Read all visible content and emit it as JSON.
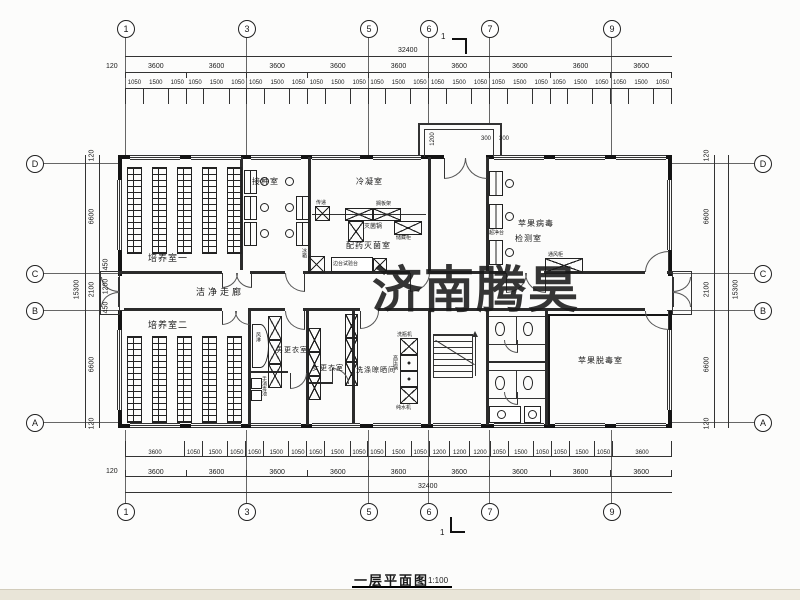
{
  "watermark": {
    "text": "济南腾昊",
    "color": "#e0394b"
  },
  "title": {
    "name": "一层平面图",
    "scale": "1:100"
  },
  "grid": {
    "top": [
      "1",
      "3",
      "5",
      "6",
      "7",
      "9"
    ],
    "bottom": [
      "1",
      "3",
      "5",
      "6",
      "7",
      "9"
    ],
    "left": [
      "D",
      "C",
      "B",
      "A"
    ],
    "right": [
      "D",
      "C",
      "B",
      "A"
    ]
  },
  "section_marker": {
    "label": "1"
  },
  "dims": {
    "top": {
      "overall": "32400",
      "edge": "120",
      "bays": [
        "3600",
        "3600",
        "3600",
        "3600",
        "3600",
        "3600",
        "3600",
        "3600",
        "3600"
      ],
      "detail": [
        "1050",
        "1500",
        "1050",
        "1050",
        "1500",
        "1050",
        "1050",
        "1500",
        "1050",
        "1050",
        "1500",
        "1050",
        "1050",
        "1500",
        "1050",
        "1050",
        "1500",
        "1050",
        "1050",
        "1500",
        "1050",
        "1050",
        "1500",
        "1050",
        "1050",
        "1500",
        "1050"
      ]
    },
    "bottom": {
      "overall": "32400",
      "edge": "120",
      "bays": [
        "3600",
        "3600",
        "3600",
        "3600",
        "3600",
        "3600",
        "3600",
        "3600",
        "3600"
      ],
      "detail": [
        "3600",
        "1050",
        "1500",
        "1050",
        "1050",
        "1500",
        "1050",
        "1050",
        "1500",
        "1050",
        "1050",
        "1500",
        "1050",
        "1200",
        "1200",
        "1200",
        "1050",
        "1500",
        "1050",
        "1050",
        "1500",
        "1050",
        "3600"
      ]
    },
    "left": {
      "overall": "15300",
      "chain": [
        "120",
        "6600",
        "2100",
        "6600",
        "120"
      ],
      "sub": [
        "450",
        "1200",
        "450"
      ]
    },
    "right": {
      "overall": "15300",
      "chain": [
        "120",
        "6600",
        "2100",
        "6600",
        "120"
      ]
    },
    "entrance": {
      "depth": "1200",
      "left": "300",
      "right": "300"
    }
  },
  "rooms": {
    "culture1": "培养室一",
    "inoculation": "接种室",
    "condense": "冷凝室",
    "dispense": "配药灭菌室",
    "virus_test_1": "苹果病毒",
    "virus_test_2": "检测室",
    "corridor": "洁净走廊",
    "culture2": "培养室二",
    "men_change": "男更衣室",
    "women_change": "女更衣室",
    "washing": "洗涤晾晒间",
    "detox": "苹果脱毒室"
  },
  "equipment": {
    "pass_box": "传递",
    "sterilizer": "灭菌锅",
    "shelf": "搁板架",
    "cabinet": "储藏柜",
    "bench": "边台试验台",
    "fridge": "冰箱",
    "clean_bench": "超净台",
    "fume_hood": "通风柜",
    "air_shower": "风淋",
    "hand_wash": "手消毒池",
    "bottle_washer": "洗瓶机",
    "autoclave": "高压锅",
    "water_purifier": "纯水机"
  }
}
